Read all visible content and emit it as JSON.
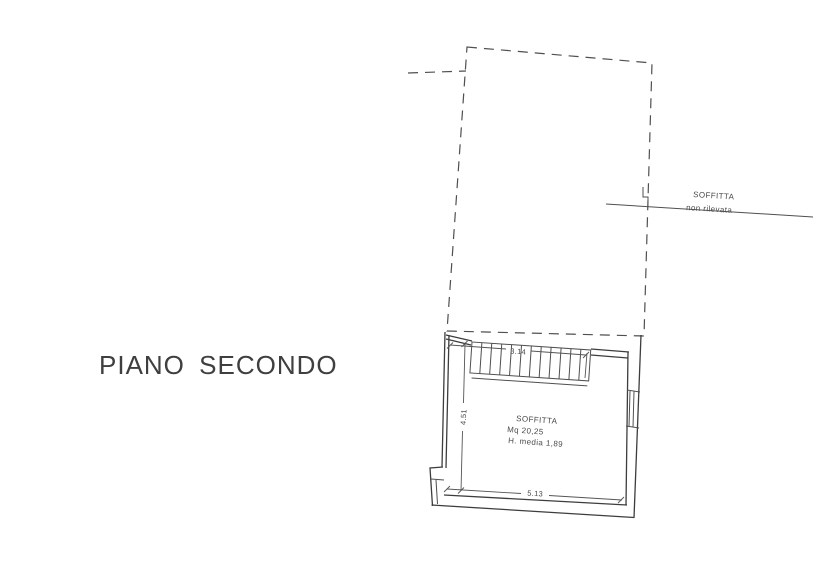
{
  "drawing": {
    "floor_label": "PIANO SECONDO",
    "attic_note": {
      "line1": "SOFFITTA",
      "line2": "non rilevata"
    },
    "room_label": {
      "name": "SOFFITTA",
      "area": "Mq 20,25",
      "height": "H. media 1,89"
    },
    "dimensions": {
      "stair_length": "3.14",
      "room_depth": "4.51",
      "room_width": "5.13"
    },
    "colors": {
      "background": "#ffffff",
      "ink": "#3d3d3d",
      "light_ink": "#4f4f4f"
    }
  }
}
